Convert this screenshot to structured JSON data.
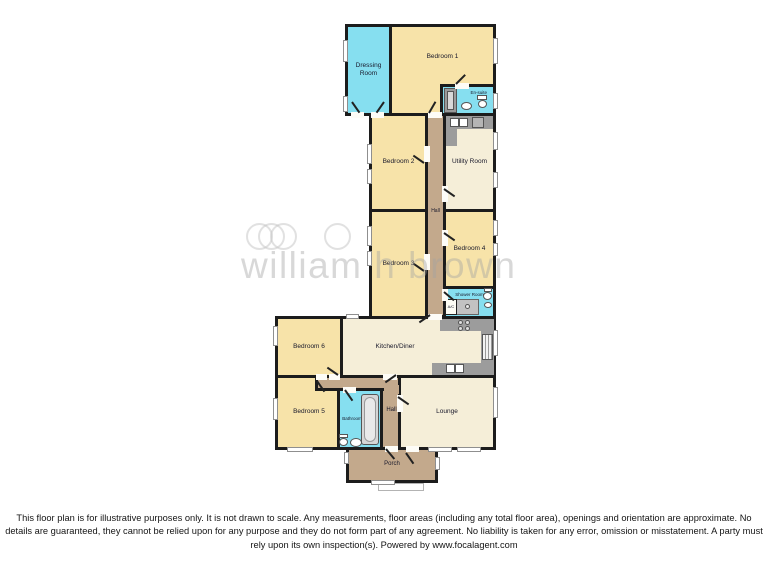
{
  "plan": {
    "rooms": [
      {
        "id": "bedroom-1",
        "label": "Bedroom 1"
      },
      {
        "id": "dressing-room",
        "label": "Dressing Room"
      },
      {
        "id": "en-suite",
        "label": "En-suite"
      },
      {
        "id": "bedroom-2",
        "label": "Bedroom 2"
      },
      {
        "id": "utility-room",
        "label": "Utility Room"
      },
      {
        "id": "hall-upper",
        "label": "Hall"
      },
      {
        "id": "bedroom-3",
        "label": "Bedroom 3"
      },
      {
        "id": "bedroom-4",
        "label": "Bedroom 4"
      },
      {
        "id": "shower-room",
        "label": "Shower Room"
      },
      {
        "id": "bedroom-6",
        "label": "Bedroom 6"
      },
      {
        "id": "kitchen-diner",
        "label": "Kitchen/Diner"
      },
      {
        "id": "bedroom-5",
        "label": "Bedroom 5"
      },
      {
        "id": "bathroom",
        "label": "Bathroom"
      },
      {
        "id": "hall-lower",
        "label": "Hall"
      },
      {
        "id": "lounge",
        "label": "Lounge"
      },
      {
        "id": "porch",
        "label": "Porch"
      },
      {
        "id": "airing-cupboard",
        "label": "A/C"
      }
    ],
    "colors": {
      "wall": "#1c1c1c",
      "bedroom": "#f7e3a9",
      "living": "#f5eed8",
      "wet": "#86dff0",
      "hall": "#c3a98c",
      "counter": "#9c9c9c"
    }
  },
  "watermark": {
    "text": "william h brown"
  },
  "footer": {
    "disclaimer": "This floor plan is for illustrative purposes only. It is not drawn to scale. Any measurements, floor areas (including any total floor area), openings and orientation are approximate. No details are guaranteed, they cannot be relied upon for any purpose and they do not form part of any agreement. No liability is taken for any error, omission or misstatement. A party must rely upon its own inspection(s). Powered by www.focalagent.com"
  }
}
